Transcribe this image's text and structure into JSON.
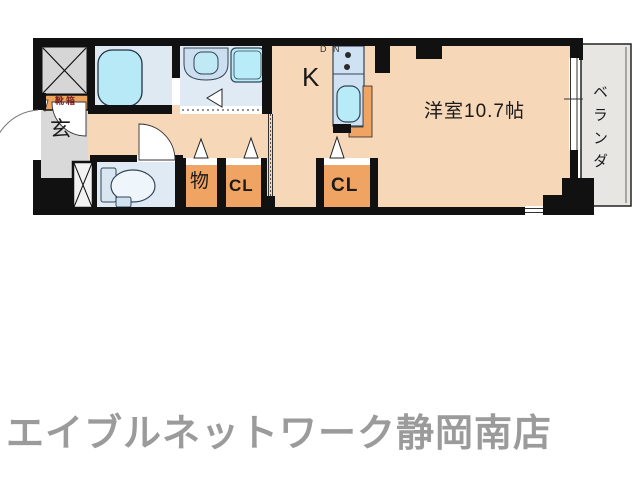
{
  "floorplan": {
    "rooms": {
      "entrance": {
        "label": "玄"
      },
      "shoe_box": {
        "label": "靴箱"
      },
      "kitchen": {
        "label": "K"
      },
      "stove": {
        "left_label": "D",
        "right_label": "N"
      },
      "storage": {
        "label": "物"
      },
      "hall_closet": {
        "label": "CL"
      },
      "room_closet": {
        "label": "CL"
      },
      "main_room": {
        "label": "洋室10.7帖"
      },
      "balcony": {
        "label": "ベランダ"
      }
    },
    "colors": {
      "wall": "#111111",
      "floor_main": "#f6d7b8",
      "floor_wet": "#dfe9f4",
      "floor_gray": "#d9d9d9",
      "floor_balcony": "#e7e6e3",
      "fixture_cyan": "#b7e9f7",
      "accent_orange": "#f0a463"
    }
  },
  "footer": {
    "store_name": "エイブルネットワーク静岡南店",
    "color": "#9b9b9b"
  }
}
